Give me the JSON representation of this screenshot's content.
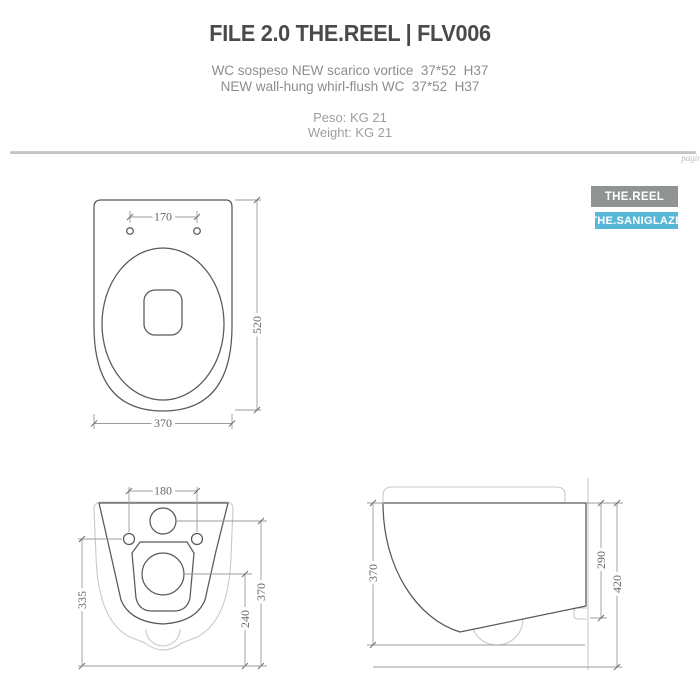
{
  "header": {
    "title": "FILE 2.0 THE.REEL | FLV006",
    "subtitle_it": "WC sospeso NEW scarico vortice  37*52  H37",
    "subtitle_en": "NEW wall-hung whirl-flush WC  37*52  H37",
    "weight_it": "Peso: KG 21",
    "weight_en": "Weight: KG 21",
    "page_marker": "pagin."
  },
  "badges": [
    {
      "label": "THE.REEL",
      "color": "#8f9490"
    },
    {
      "label": "THE.SANIGLAZE",
      "color": "#58b7d7"
    }
  ],
  "drawings": {
    "top_view": {
      "dim_holes": "170",
      "dim_depth": "520",
      "dim_width": "370"
    },
    "back_view": {
      "dim_bolts": "180",
      "dim_left_height": "335",
      "dim_drain_height": "240",
      "dim_right_height": "370"
    },
    "side_view": {
      "dim_depth": "370",
      "dim_back_height": "290",
      "dim_total_height": "420"
    }
  },
  "colors": {
    "title_text": "#4a4a4a",
    "subtitle_text": "#8d8d8d",
    "divider": "#c2c2c2",
    "drawing_dark_line": "#585858",
    "drawing_light_line": "#c9c9c9",
    "dimension_line": "#9b9b9b",
    "dimension_text": "#666666"
  }
}
